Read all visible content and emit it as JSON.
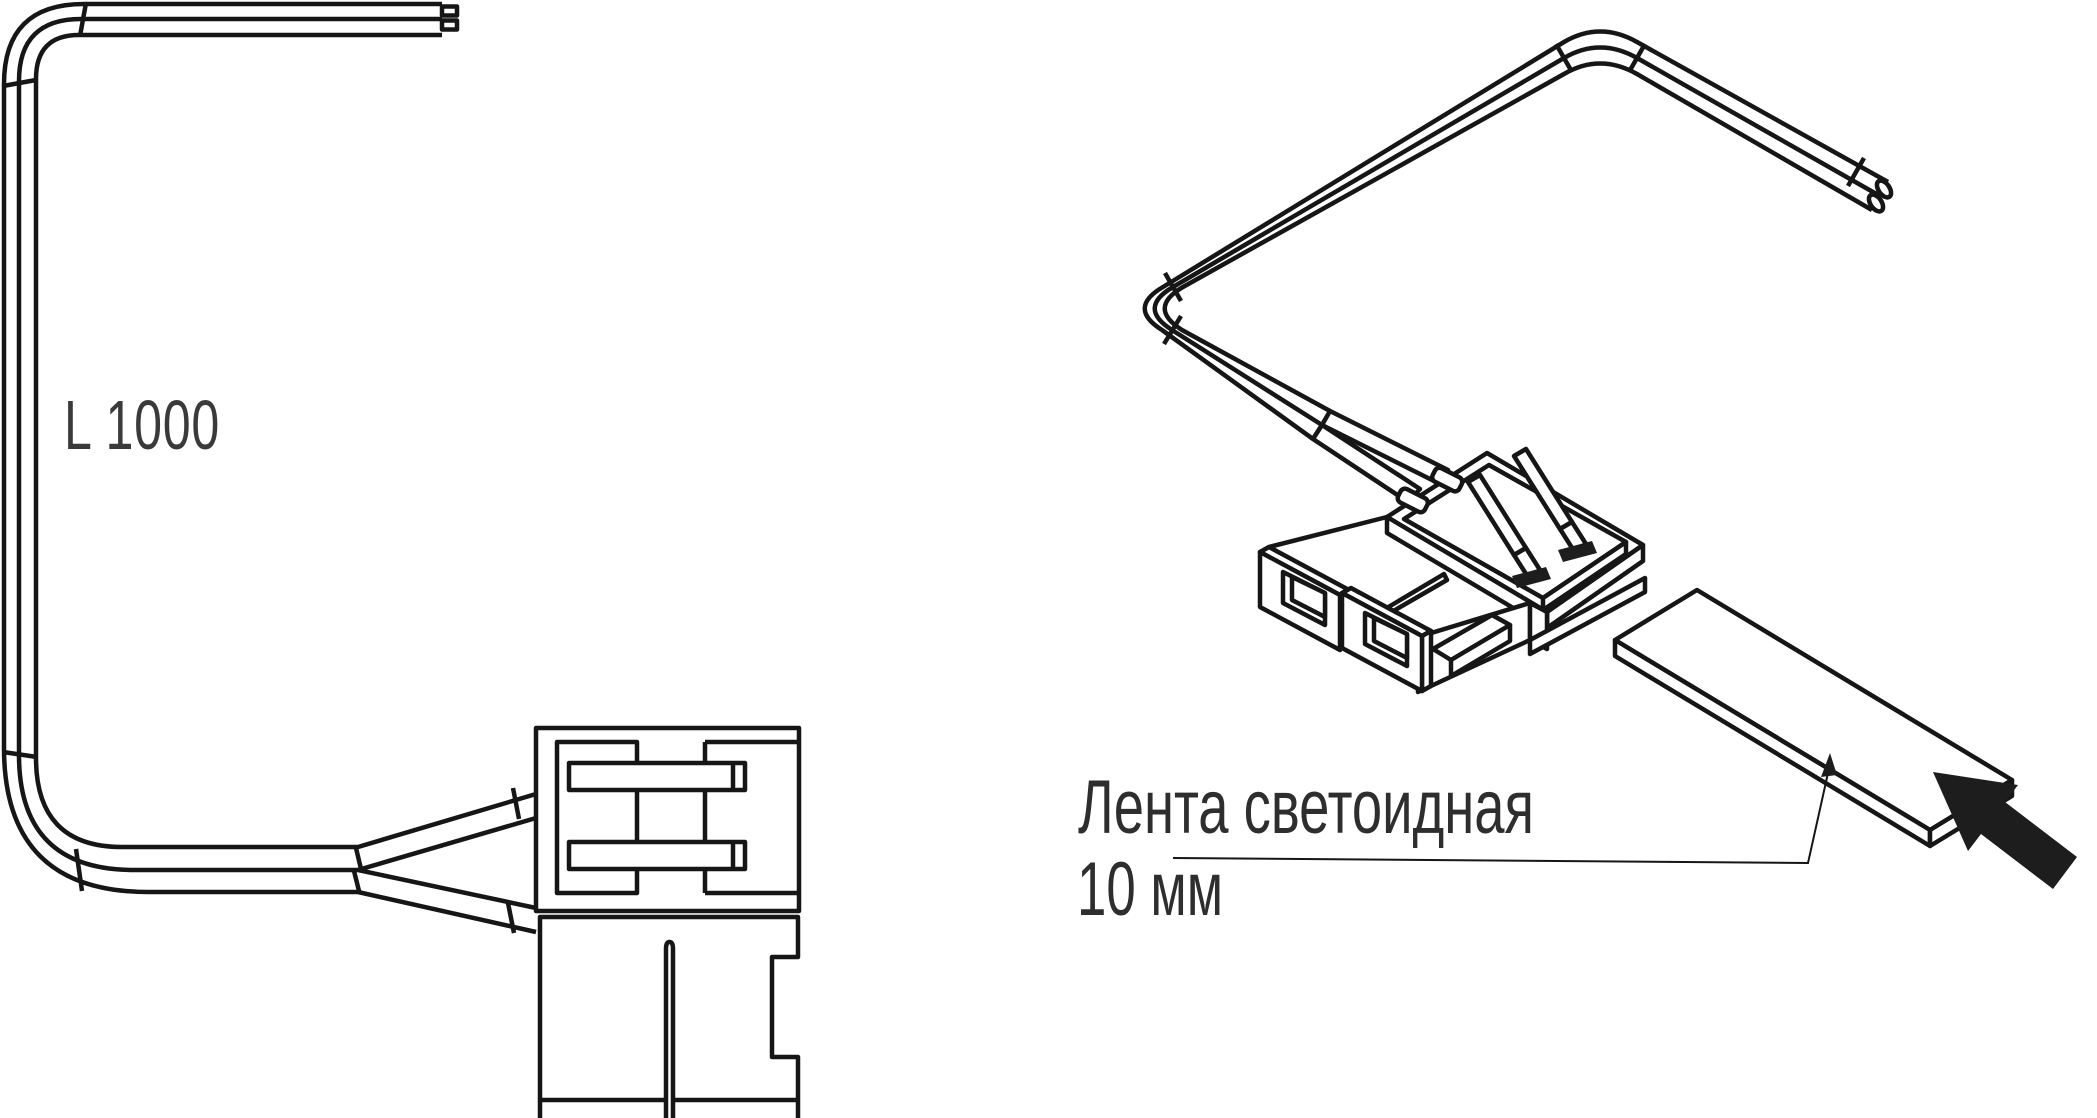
{
  "labels": {
    "length_label": "L 1000",
    "strip_label_line1": "Лента светоидная",
    "strip_label_line2": "10 мм"
  },
  "colors": {
    "line": "#161616",
    "label_text": "#2e2e2e",
    "dimension_text": "#3a3a3a",
    "cursor_arrow_fill": "#2b2b2b",
    "background": "#ffffff"
  },
  "icons": {
    "cursor_arrow": "cursor-arrow-icon",
    "leader_arrowhead": "arrowhead-icon"
  }
}
